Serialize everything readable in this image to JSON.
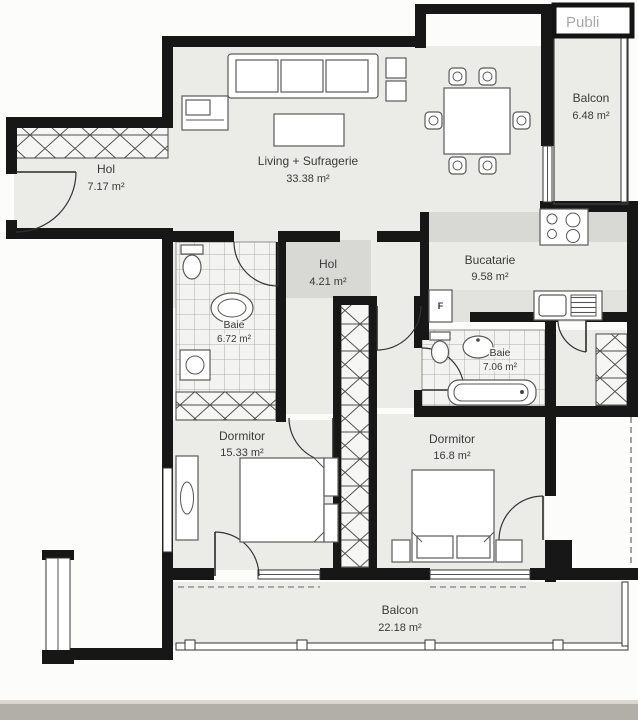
{
  "watermark": {
    "text": "Publi"
  },
  "plan": {
    "rooms": [
      {
        "id": "hol-entry",
        "name": "Hol",
        "area": "7.17 m²"
      },
      {
        "id": "living-sufragerie",
        "name": "Living + Sufragerie",
        "area": "33.38 m²"
      },
      {
        "id": "balcon-sus",
        "name": "Balcon",
        "area": "6.48 m²"
      },
      {
        "id": "bucatarie",
        "name": "Bucatarie",
        "area": "9.58 m²"
      },
      {
        "id": "hol-center",
        "name": "Hol",
        "area": "4.21 m²"
      },
      {
        "id": "baie-stanga",
        "name": "Baie",
        "area": "6.72 m²"
      },
      {
        "id": "baie-dreapta",
        "name": "Baie",
        "area": "7.06 m²"
      },
      {
        "id": "dormitor-stanga",
        "name": "Dormitor",
        "area": "15.33 m²"
      },
      {
        "id": "dormitor-dreapta",
        "name": "Dormitor",
        "area": "16.8 m²"
      },
      {
        "id": "balcon-jos",
        "name": "Balcon",
        "area": "22.18 m²"
      }
    ],
    "appliance_labels": {
      "fridge": "F"
    },
    "colors": {
      "wall": "#171717",
      "floor": "#ebebe8",
      "shaded_zone": "#d8d8d4",
      "tile_background": "#f3f3f1",
      "background": "#fcfcfb",
      "label_text": "#3a3a3a"
    }
  }
}
